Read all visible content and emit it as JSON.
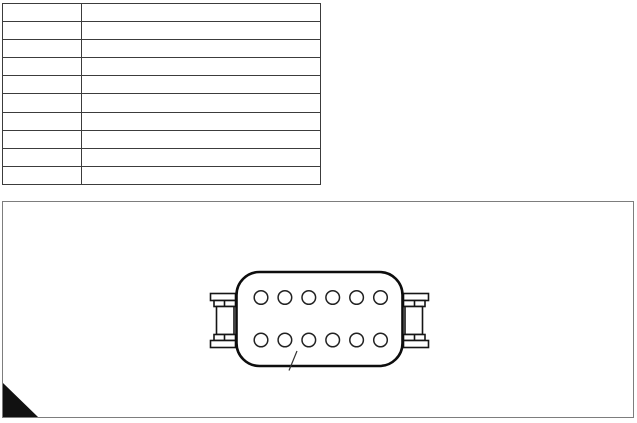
{
  "canvas": {
    "width": 637,
    "height": 423,
    "background": "#ffffff"
  },
  "spec_table": {
    "rows": 10,
    "columns": 2,
    "border_color": "#3c3c3c",
    "cells": [
      [
        "",
        ""
      ],
      [
        "",
        ""
      ],
      [
        "",
        ""
      ],
      [
        "",
        ""
      ],
      [
        "",
        ""
      ],
      [
        "",
        ""
      ],
      [
        "",
        ""
      ],
      [
        "",
        ""
      ],
      [
        "",
        ""
      ],
      [
        "",
        ""
      ]
    ]
  },
  "diagram_panel": {
    "border_color": "#7d7d7d",
    "fold_marker": {
      "shape": "right-triangle",
      "position": "bottom-left",
      "color": "#111111"
    }
  },
  "connector": {
    "view": "connector-face",
    "pin_rows": 2,
    "pins_per_row": 6,
    "total_pins": 12,
    "outline_color": "#0d0d0d",
    "pin_outline_color": "#222222",
    "mounting_clips": [
      "left",
      "right"
    ],
    "has_leader_line": true
  }
}
